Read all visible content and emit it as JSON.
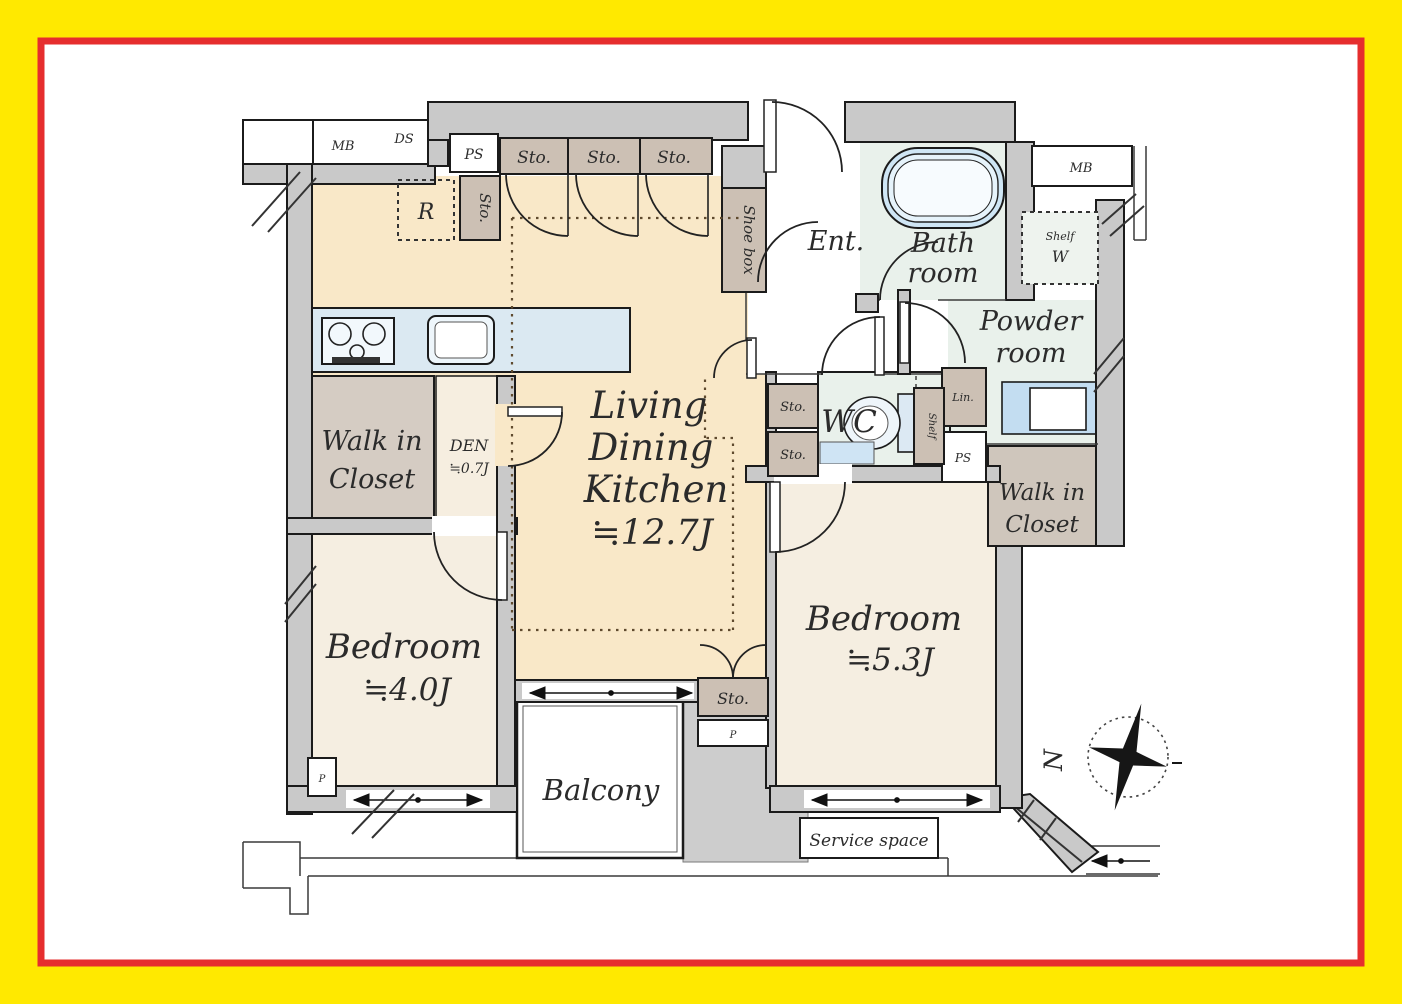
{
  "labels": {
    "mb": "MB",
    "ds": "DS",
    "ps": "PS",
    "sto": "Sto.",
    "r": "R",
    "shoe_box": "Shoe box",
    "ent": "Ent.",
    "bath_line1": "Bath",
    "bath_line2": "room",
    "shelf_w_line1": "Shelf",
    "shelf_w_line2": "W",
    "powder_line1": "Powder",
    "powder_line2": "room",
    "wc": "WC",
    "shelf": "Shelf",
    "lin": "Lin.",
    "walk_in": "Walk in",
    "closet": "Closet",
    "den": "DEN",
    "den_area": "≒0.7J",
    "ldk_line1": "Living",
    "ldk_line2": "Dining",
    "ldk_line3": "Kitchen",
    "ldk_area": "≒12.7J",
    "bedroom": "Bedroom",
    "bedroom1_area": "≒4.0J",
    "bedroom2_area": "≒5.3J",
    "balcony": "Balcony",
    "service_space": "Service space",
    "p": "P",
    "north": "N"
  },
  "colors": {
    "frame_yellow": "#ffe900",
    "frame_red": "#e62e2e",
    "wall_gray": "#c9c9c9",
    "ldk_cream": "#f9e8c8",
    "bedroom_ivory": "#f5eee1",
    "closet_taupe": "#d5ccc3",
    "wet_area_green": "#e9f1eb",
    "fixture_blue": "#c3ddf1",
    "storage_brown": "#ccc0b4"
  }
}
